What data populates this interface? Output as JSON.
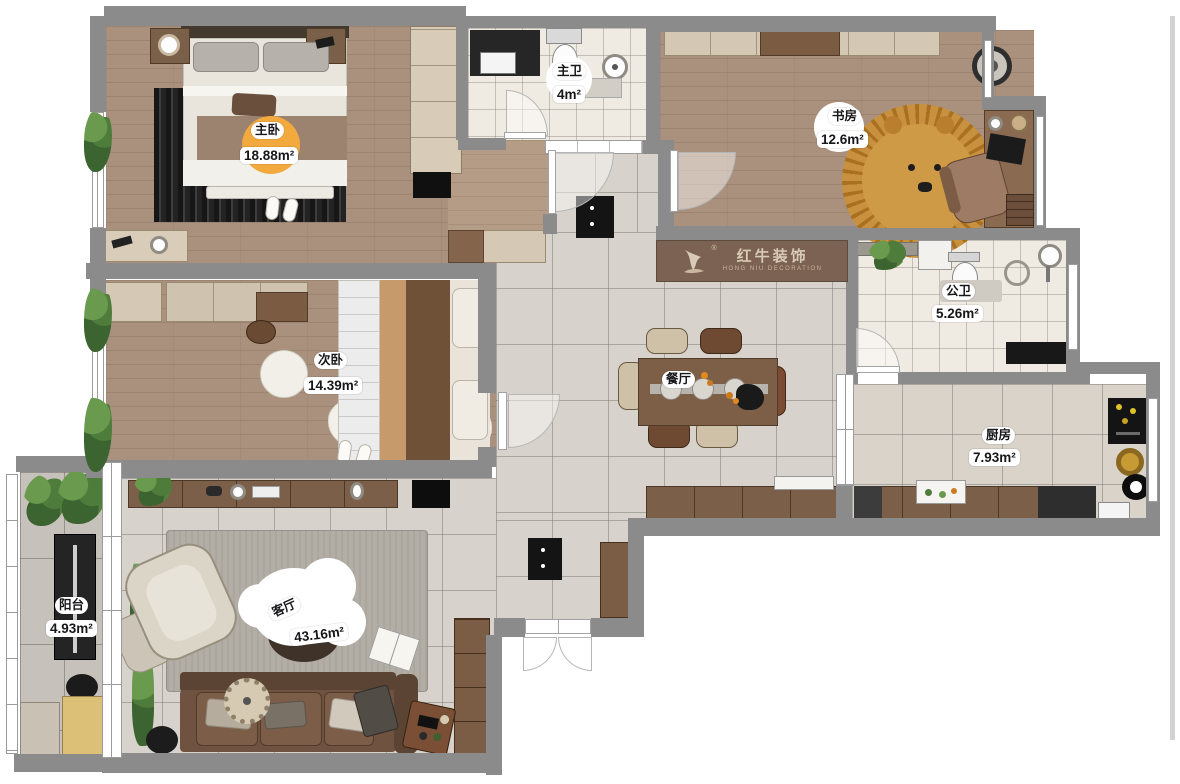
{
  "brand": {
    "name": "红牛装饰",
    "name_en": "HONG NIU DECORATION",
    "reg": "®"
  },
  "rooms": [
    {
      "id": "master-bedroom",
      "name": "主卧",
      "area": "18.88m²"
    },
    {
      "id": "master-bath",
      "name": "主卫",
      "area": "4m²"
    },
    {
      "id": "study",
      "name": "书房",
      "area": "12.6m²"
    },
    {
      "id": "public-bath",
      "name": "公卫",
      "area": "5.26m²"
    },
    {
      "id": "second-bedroom",
      "name": "次卧",
      "area": "14.39m²"
    },
    {
      "id": "dining-room",
      "name": "餐厅",
      "area": ""
    },
    {
      "id": "kitchen",
      "name": "厨房",
      "area": "7.93m²"
    },
    {
      "id": "living-room",
      "name": "客厅",
      "area": "43.16m²"
    },
    {
      "id": "balcony",
      "name": "阳台",
      "area": "4.93m²"
    }
  ],
  "colors": {
    "wall": "#8b8b8b",
    "wood_floor": "#a9917d",
    "tile_floor": "#d7d2cb",
    "bath_tile": "#f0ebe2",
    "label_accent": "#f2a93e",
    "logo_bg": "#7b6252",
    "logo_text": "#d9cab5"
  }
}
